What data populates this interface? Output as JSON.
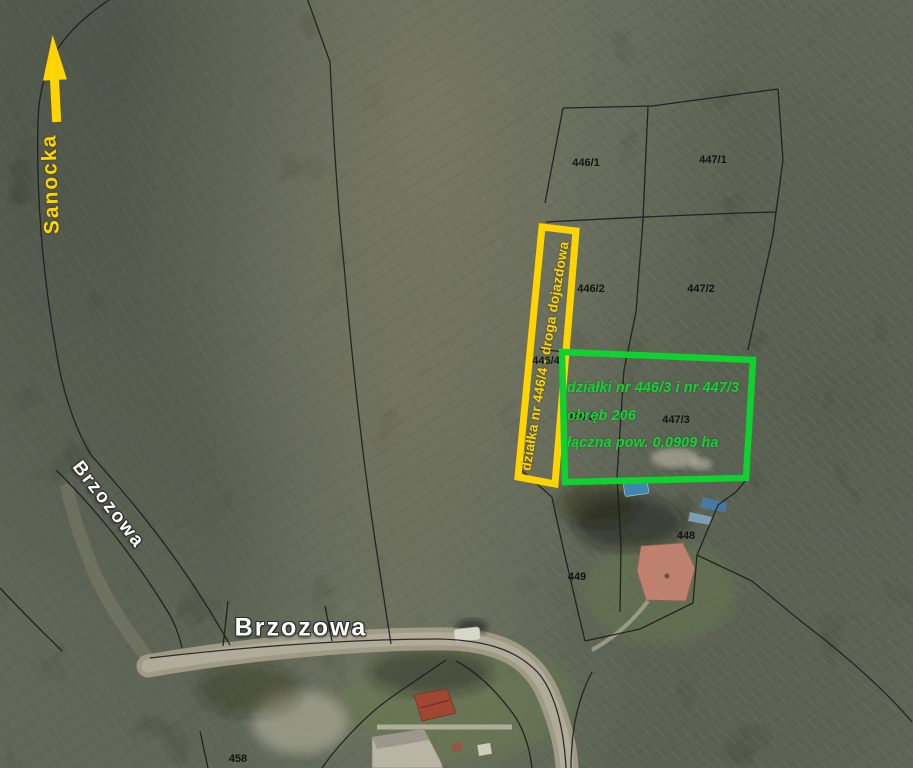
{
  "map": {
    "kind": "aerial-cadastral-photo",
    "north_arrow": {
      "icon": "arrow-up",
      "color": "#FFD400"
    },
    "streets": {
      "sanocka": "Sanocka",
      "brzozowa_diagonal": "Brzozowa",
      "brzozowa_horizontal": "Brzozowa"
    },
    "parcels": [
      {
        "id": "446/1"
      },
      {
        "id": "447/1"
      },
      {
        "id": "446/2"
      },
      {
        "id": "447/2"
      },
      {
        "id": "446/3"
      },
      {
        "id": "447/3"
      },
      {
        "id": "446/4"
      },
      {
        "id": "448"
      },
      {
        "id": "449"
      },
      {
        "id": "458"
      }
    ],
    "highlights": {
      "access_road": {
        "label": "działka nr 446/4 - droga dojazdowa",
        "color": "#FFD400"
      },
      "offer_area": {
        "line1": "działki nr 446/3 i nr 447/3",
        "line2": "obręb 206",
        "line3": "łączna pow. 0,0909 ha",
        "color": "#12D535"
      }
    },
    "colors": {
      "highlight_yellow": "#FFD400",
      "highlight_green": "#0FD12F",
      "boundary_line": "#1a1a1a"
    }
  }
}
